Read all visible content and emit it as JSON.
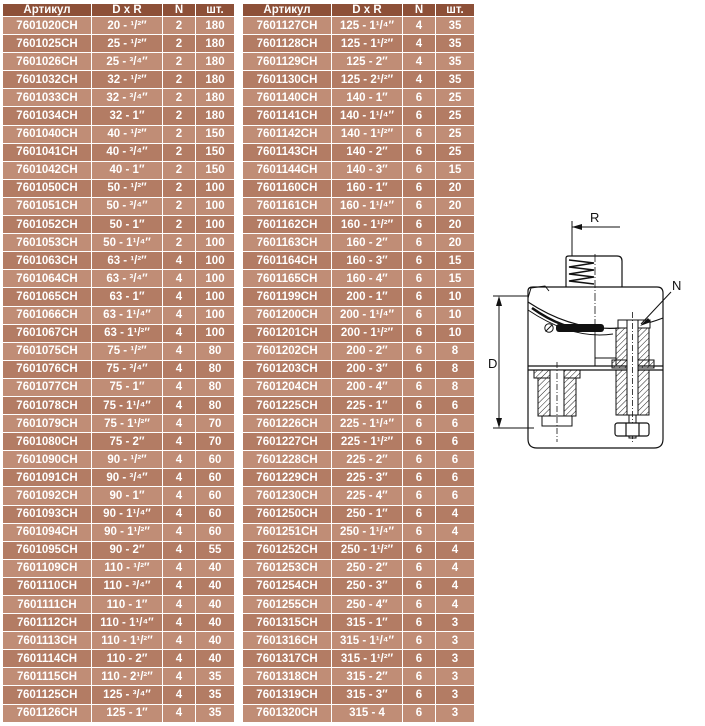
{
  "columns": {
    "article": "Артикул",
    "dxr": "D x R",
    "n": "N",
    "qty": "шт."
  },
  "colors": {
    "header_bg": "#8d5038",
    "row_light": "#c08d76",
    "row_dark": "#b37c64",
    "table_text": "#ffffff",
    "diagram_line": "#111111"
  },
  "tables": {
    "left": {
      "rows": [
        [
          "7601020CH",
          "20 - ¹/²″",
          "2",
          "180"
        ],
        [
          "7601025CH",
          "25 - ¹/²″",
          "2",
          "180"
        ],
        [
          "7601026CH",
          "25 - ³/⁴″",
          "2",
          "180"
        ],
        [
          "7601032CH",
          "32 - ¹/²″",
          "2",
          "180"
        ],
        [
          "7601033CH",
          "32 - ³/⁴″",
          "2",
          "180"
        ],
        [
          "7601034CH",
          "32 - 1″",
          "2",
          "180"
        ],
        [
          "7601040CH",
          "40 - ¹/²″",
          "2",
          "150"
        ],
        [
          "7601041CH",
          "40 - ³/⁴″",
          "2",
          "150"
        ],
        [
          "7601042CH",
          "40 - 1″",
          "2",
          "150"
        ],
        [
          "7601050CH",
          "50 - ¹/²″",
          "2",
          "100"
        ],
        [
          "7601051CH",
          "50 - ³/⁴″",
          "2",
          "100"
        ],
        [
          "7601052CH",
          "50 - 1″",
          "2",
          "100"
        ],
        [
          "7601053CH",
          "50 - 1¹/⁴″",
          "2",
          "100"
        ],
        [
          "7601063CH",
          "63 - ¹/²″",
          "4",
          "100"
        ],
        [
          "7601064CH",
          "63 - ³/⁴″",
          "4",
          "100"
        ],
        [
          "7601065CH",
          "63 - 1″",
          "4",
          "100"
        ],
        [
          "7601066CH",
          "63 - 1¹/⁴″",
          "4",
          "100"
        ],
        [
          "7601067CH",
          "63 - 1¹/²″",
          "4",
          "100"
        ],
        [
          "7601075CH",
          "75 - ¹/²″",
          "4",
          "80"
        ],
        [
          "7601076CH",
          "75 - ³/⁴″",
          "4",
          "80"
        ],
        [
          "7601077CH",
          "75 - 1″",
          "4",
          "80"
        ],
        [
          "7601078CH",
          "75 - 1¹/⁴″",
          "4",
          "80"
        ],
        [
          "7601079CH",
          "75 - 1¹/²″",
          "4",
          "70"
        ],
        [
          "7601080CH",
          "75 - 2″",
          "4",
          "70"
        ],
        [
          "7601090CH",
          "90 - ¹/²″",
          "4",
          "60"
        ],
        [
          "7601091CH",
          "90 - ³/⁴″",
          "4",
          "60"
        ],
        [
          "7601092CH",
          "90 - 1″",
          "4",
          "60"
        ],
        [
          "7601093CH",
          "90 - 1¹/⁴″",
          "4",
          "60"
        ],
        [
          "7601094CH",
          "90 - 1¹/²″",
          "4",
          "60"
        ],
        [
          "7601095CH",
          "90 - 2″",
          "4",
          "55"
        ],
        [
          "7601109CH",
          "110 - ¹/²″",
          "4",
          "40"
        ],
        [
          "7601110CH",
          "110 - ³/⁴″",
          "4",
          "40"
        ],
        [
          "7601111CH",
          "110 - 1″",
          "4",
          "40"
        ],
        [
          "7601112CH",
          "110 - 1¹/⁴″",
          "4",
          "40"
        ],
        [
          "7601113CH",
          "110 - 1¹/²″",
          "4",
          "40"
        ],
        [
          "7601114CH",
          "110 - 2″",
          "4",
          "40"
        ],
        [
          "7601115CH",
          "110 - 2¹/²″",
          "4",
          "35"
        ],
        [
          "7601125CH",
          "125 - ³/⁴″",
          "4",
          "35"
        ],
        [
          "7601126CH",
          "125 - 1″",
          "4",
          "35"
        ]
      ]
    },
    "right": {
      "rows": [
        [
          "7601127CH",
          "125 - 1¹/⁴″",
          "4",
          "35"
        ],
        [
          "7601128CH",
          "125 - 1¹/²″",
          "4",
          "35"
        ],
        [
          "7601129CH",
          "125 - 2″",
          "4",
          "35"
        ],
        [
          "7601130CH",
          "125 - 2¹/²″",
          "4",
          "35"
        ],
        [
          "7601140CH",
          "140 - 1″",
          "6",
          "25"
        ],
        [
          "7601141CH",
          "140 - 1¹/⁴″",
          "6",
          "25"
        ],
        [
          "7601142CH",
          "140 - 1¹/²″",
          "6",
          "25"
        ],
        [
          "7601143CH",
          "140 - 2″",
          "6",
          "25"
        ],
        [
          "7601144CH",
          "140 - 3″",
          "6",
          "15"
        ],
        [
          "7601160CH",
          "160 - 1″",
          "6",
          "20"
        ],
        [
          "7601161CH",
          "160 - 1¹/⁴″",
          "6",
          "20"
        ],
        [
          "7601162CH",
          "160 - 1¹/²″",
          "6",
          "20"
        ],
        [
          "7601163CH",
          "160 - 2″",
          "6",
          "20"
        ],
        [
          "7601164CH",
          "160 - 3″",
          "6",
          "15"
        ],
        [
          "7601165CH",
          "160 - 4″",
          "6",
          "15"
        ],
        [
          "7601199CH",
          "200 - 1″",
          "6",
          "10"
        ],
        [
          "7601200CH",
          "200 - 1¹/⁴″",
          "6",
          "10"
        ],
        [
          "7601201CH",
          "200 - 1¹/²″",
          "6",
          "10"
        ],
        [
          "7601202CH",
          "200 - 2″",
          "6",
          "8"
        ],
        [
          "7601203CH",
          "200 - 3″",
          "6",
          "8"
        ],
        [
          "7601204CH",
          "200 - 4″",
          "6",
          "8"
        ],
        [
          "7601225CH",
          "225 - 1″",
          "6",
          "6"
        ],
        [
          "7601226CH",
          "225 - 1¹/⁴″",
          "6",
          "6"
        ],
        [
          "7601227CH",
          "225 - 1¹/²″",
          "6",
          "6"
        ],
        [
          "7601228CH",
          "225 - 2″",
          "6",
          "6"
        ],
        [
          "7601229CH",
          "225 - 3″",
          "6",
          "6"
        ],
        [
          "7601230CH",
          "225 - 4″",
          "6",
          "6"
        ],
        [
          "7601250CH",
          "250 - 1″",
          "6",
          "4"
        ],
        [
          "7601251CH",
          "250 - 1¹/⁴″",
          "6",
          "4"
        ],
        [
          "7601252CH",
          "250 - 1¹/²″",
          "6",
          "4"
        ],
        [
          "7601253CH",
          "250 - 2″",
          "6",
          "4"
        ],
        [
          "7601254CH",
          "250 - 3″",
          "6",
          "4"
        ],
        [
          "7601255CH",
          "250 - 4″",
          "6",
          "4"
        ],
        [
          "7601315CH",
          "315 - 1″",
          "6",
          "3"
        ],
        [
          "7601316CH",
          "315 - 1¹/⁴″",
          "6",
          "3"
        ],
        [
          "7601317CH",
          "315 - 1¹/²″",
          "6",
          "3"
        ],
        [
          "7601318CH",
          "315 - 2″",
          "6",
          "3"
        ],
        [
          "7601319CH",
          "315 - 3″",
          "6",
          "3"
        ],
        [
          "7601320CH",
          "315 - 4",
          "6",
          "3"
        ]
      ]
    }
  },
  "diagram": {
    "labels": {
      "r": "R",
      "n": "N",
      "d": "D"
    }
  }
}
